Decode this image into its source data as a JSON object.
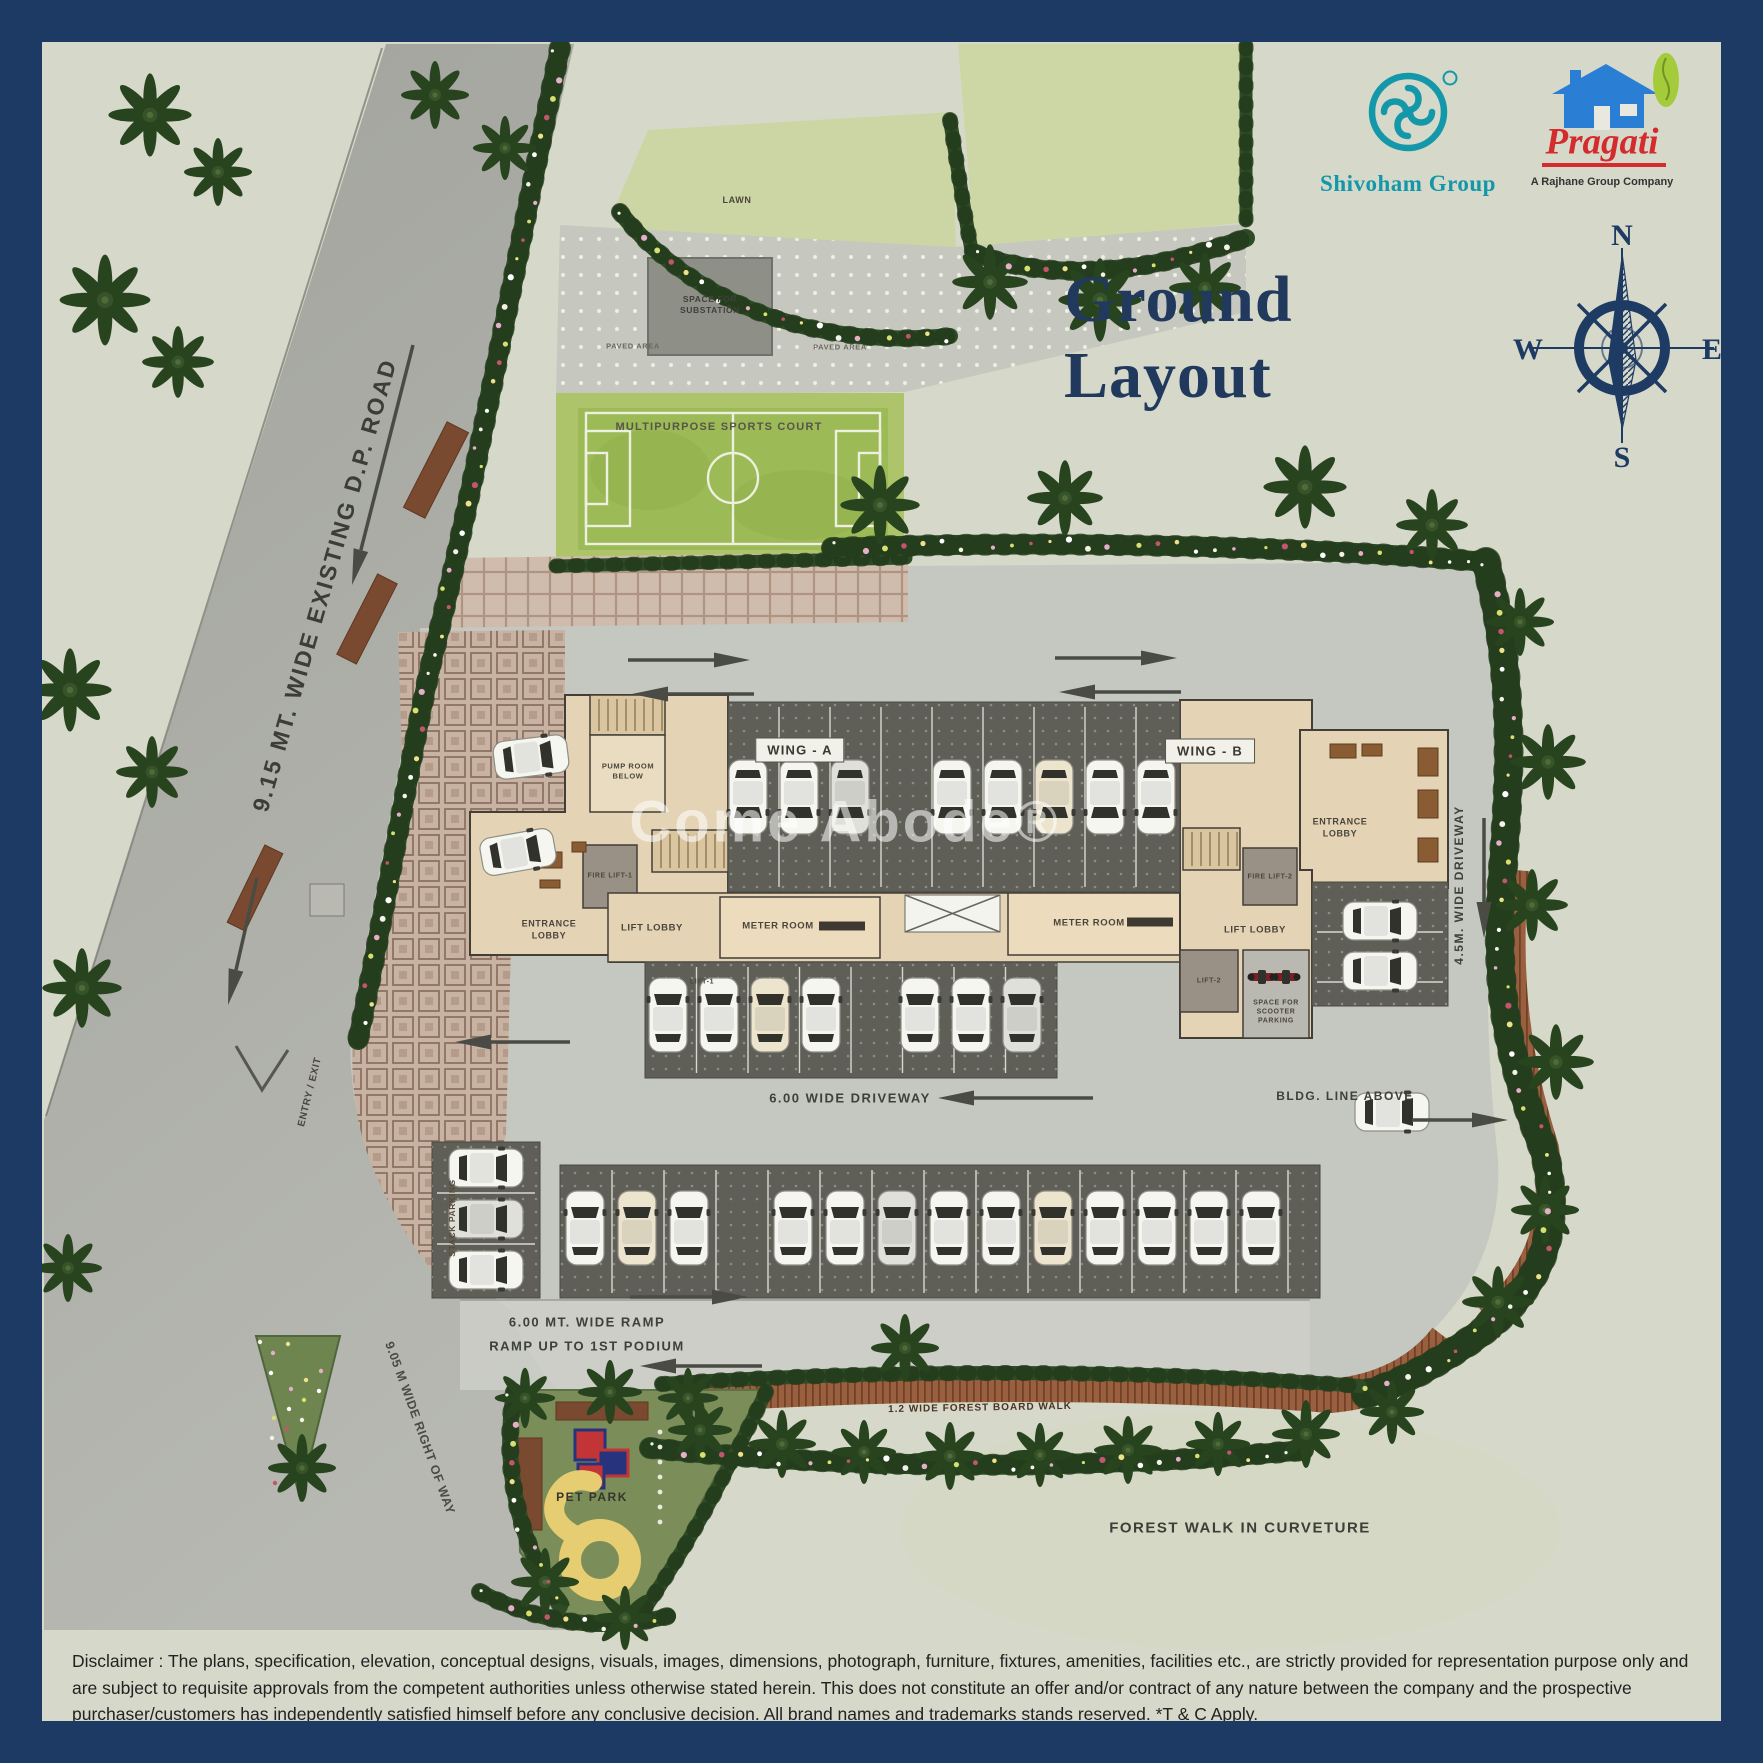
{
  "page": {
    "title": "Ground Layout",
    "watermark": "Come Abode®"
  },
  "branding": {
    "shivoham": {
      "name": "Shivoham Group",
      "color": "#1398a9"
    },
    "pragati": {
      "name": "Pragati",
      "tagline": "A Rajhane Group Company",
      "red": "#d42b2d",
      "blue": "#2a7fd4",
      "green": "#a4cb3a"
    }
  },
  "compass": {
    "north": "N",
    "east": "E",
    "south": "S",
    "west": "W"
  },
  "roads": {
    "dp_road": "9.15 MT. WIDE EXISTING D.P. ROAD",
    "entry_exit": "ENTRY / EXIT",
    "right_of_way": "9.05 M WIDE RIGHT OF WAY"
  },
  "site": {
    "lawn": "LAWN",
    "substation": "SPACE FOR SUBSTATION",
    "paved_area_left": "PAVED AREA",
    "paved_area_right": "PAVED AREA",
    "sports_court": "MULTIPURPOSE SPORTS COURT",
    "pet_park": "PET PARK",
    "board_walk": "1.2 WIDE FOREST BOARD WALK",
    "forest_walk": "FOREST WALK IN CURVETURE"
  },
  "building": {
    "wing_a": {
      "label": "WING - A",
      "entrance_lobby": "ENTRANCE LOBBY",
      "lift_lobby": "LIFT LOBBY",
      "meter_room": "METER ROOM",
      "pump_room": "PUMP ROOM BELOW",
      "fire_lift": "FIRE LIFT-1",
      "lift": "LIFT-1"
    },
    "wing_b": {
      "label": "WING - B",
      "entrance_lobby": "ENTRANCE LOBBY",
      "lift_lobby": "LIFT LOBBY",
      "meter_room": "METER ROOM",
      "fire_lift": "FIRE LIFT-2",
      "lift": "LIFT-2",
      "scooter": "SPACE FOR SCOOTER PARKING"
    },
    "stack_parking": "STACK PARKING",
    "bldg_line": "BLDG. LINE ABOVE"
  },
  "driveways": {
    "main": "6.00 WIDE DRIVEWAY",
    "side": "4.5M. WIDE DRIVEWAY",
    "ramp_l1": "6.00 MT. WIDE RAMP",
    "ramp_l2": "RAMP UP TO 1ST PODIUM"
  },
  "disclaimer": "Disclaimer : The plans, specification, elevation, conceptual designs, visuals, images, dimensions, photograph, furniture, fixtures, amenities, facilities etc., are strictly provided for representation purpose only and are subject to requisite approvals from the competent authorities unless otherwise stated herein. This does not constitute an offer and/or contract of any nature between the company and the prospective purchaser/customers has independently satisfied himself before any conclusive decision.  All brand names and trademarks stands reserved. *T & C Apply.",
  "colors": {
    "frame": "#1c3a63",
    "background": "#d6d8ca",
    "road": "#a6a7a1",
    "court": "#9cba56",
    "building_tan": "#e4d4b5",
    "hedge": "#2f4d26",
    "stall": "#5f5f58"
  }
}
